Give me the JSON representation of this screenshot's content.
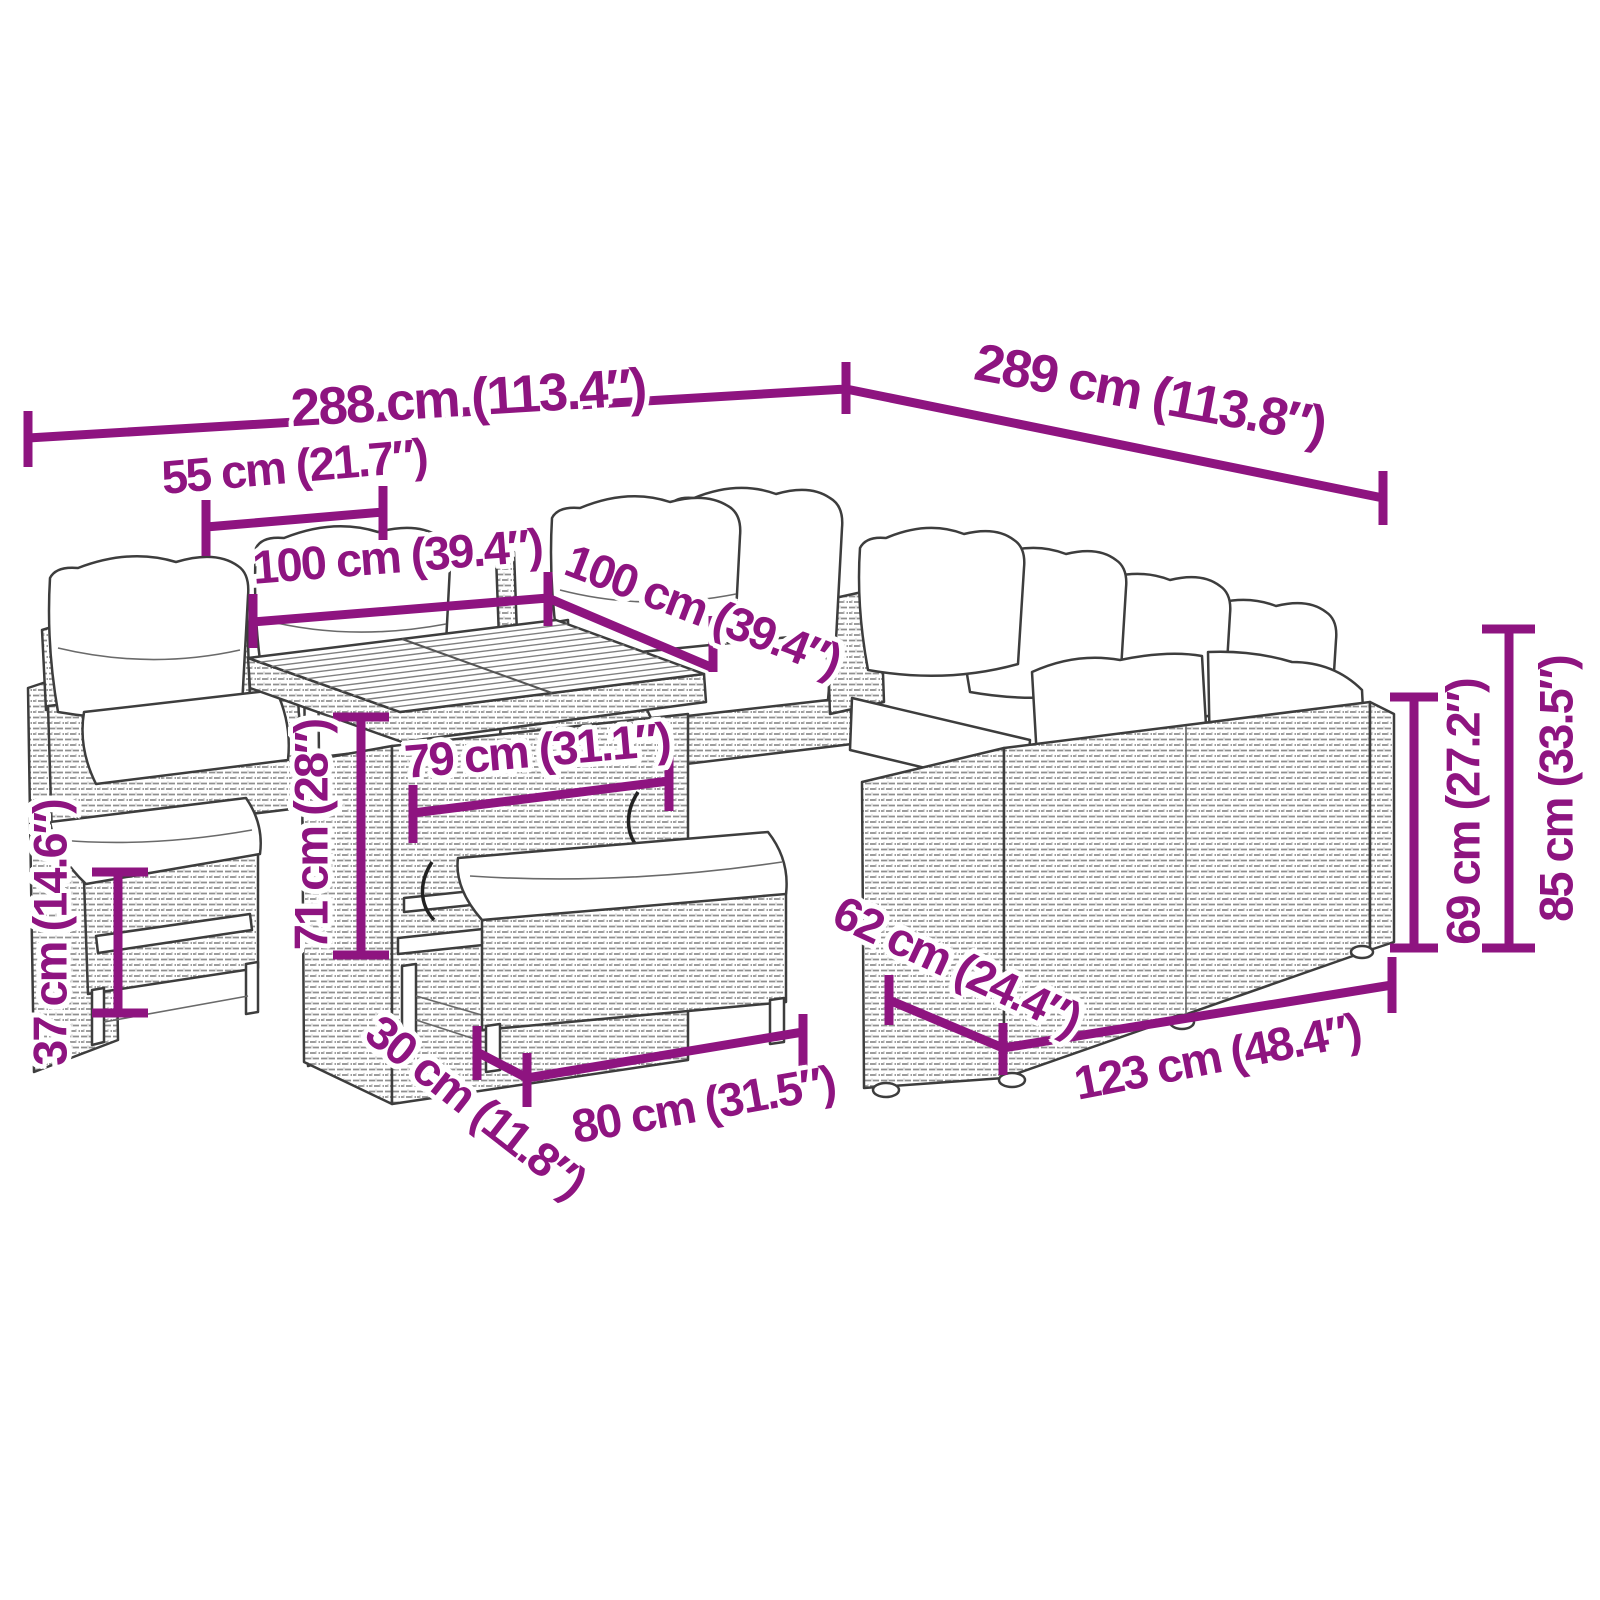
{
  "figure": {
    "type": "product-dimension-diagram",
    "subject": "outdoor rattan garden lounge set with corner sofa, cushions, lift-top table and benches",
    "background": "#ffffff"
  },
  "colors": {
    "accent": "#8E1480",
    "outline": "#3D3D3D",
    "rattan_weave": "#909090"
  },
  "dimensions": [
    {
      "id": "overall-width-left",
      "text": "288 cm (113.4″)"
    },
    {
      "id": "overall-width-right",
      "text": "289 cm (113.8″)"
    },
    {
      "id": "seat-width",
      "text": "55 cm (21.7″)"
    },
    {
      "id": "table-side-left",
      "text": "100 cm (39.4″)"
    },
    {
      "id": "table-side-right",
      "text": "100 cm (39.4″)"
    },
    {
      "id": "table-inner-width",
      "text": "79 cm (31.1″)"
    },
    {
      "id": "table-height",
      "text": "71 cm (28″)"
    },
    {
      "id": "small-bench-height",
      "text": "37 cm (14.6″)"
    },
    {
      "id": "bench-depth",
      "text": "30 cm (11.8″)"
    },
    {
      "id": "bench-width",
      "text": "80 cm (31.5″)"
    },
    {
      "id": "sofa-depth",
      "text": "62 cm (24.4″)"
    },
    {
      "id": "sofa-module-width",
      "text": "123 cm (48.4″)"
    },
    {
      "id": "seat-back-height",
      "text": "69 cm (27.2″)"
    },
    {
      "id": "backrest-height",
      "text": "85 cm (33.5″)"
    }
  ]
}
